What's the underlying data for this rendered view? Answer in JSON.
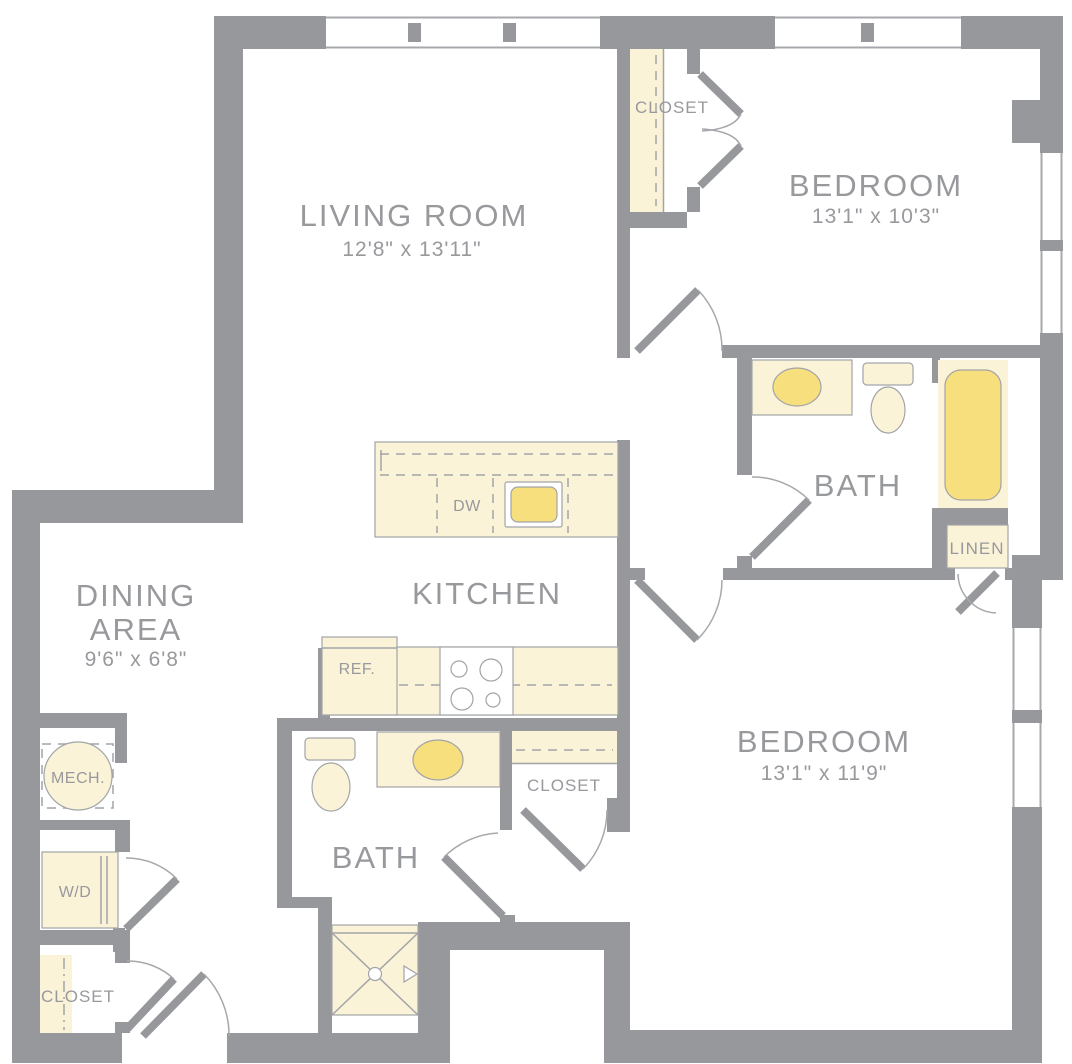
{
  "colors": {
    "wall": "#97989B",
    "label_text": "#97999C",
    "fixture_fill": "#FBF3D8",
    "fixture_accent": "#F8DF7D",
    "fixture_outline": "#A2A4A7"
  },
  "rooms": {
    "living_room": {
      "label": "LIVING ROOM",
      "dimensions": "12'8\" x 13'11\""
    },
    "bedroom_top": {
      "label": "BEDROOM",
      "dimensions": "13'1\" x 10'3\""
    },
    "bedroom_bottom": {
      "label": "BEDROOM",
      "dimensions": "13'1\" x 11'9\""
    },
    "dining_area": {
      "label_line1": "DINING",
      "label_line2": "AREA",
      "dimensions": "9'6\" x 6'8\""
    },
    "kitchen": {
      "label": "KITCHEN"
    },
    "bath_top": {
      "label": "BATH"
    },
    "bath_bottom": {
      "label": "BATH"
    },
    "closet_bedroom_top": {
      "label": "CLOSET"
    },
    "closet_hall": {
      "label": "CLOSET"
    },
    "closet_entry": {
      "label": "CLOSET"
    },
    "linen_closet": {
      "label": "LINEN"
    },
    "mechanical": {
      "label": "MECH."
    },
    "laundry": {
      "label": "W/D"
    }
  },
  "appliances": {
    "dishwasher": {
      "label": "DW"
    },
    "refrigerator": {
      "label": "REF."
    }
  }
}
